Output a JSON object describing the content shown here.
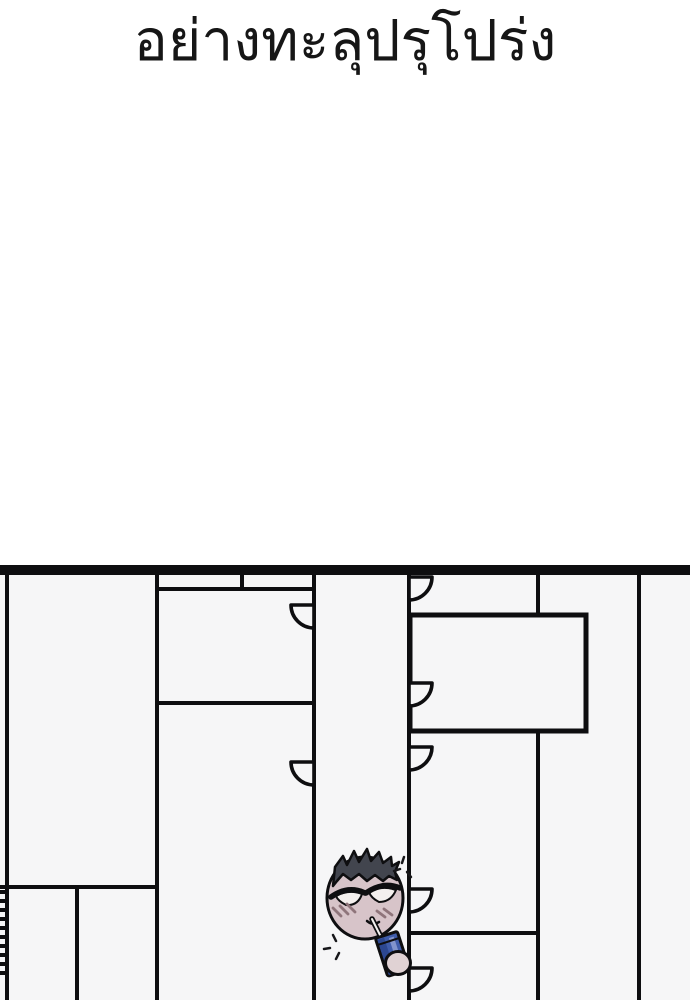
{
  "title": {
    "text": "อย่างทะลุปรุโปร่ง"
  },
  "colors": {
    "ink": "#0e0e10",
    "paper": "#ffffff",
    "panel_bg": "#f6f6f7",
    "face": "#d7c4c9",
    "hair": "#42454e",
    "eye_white": "#f4f0ee",
    "blush": "#8f757b",
    "straw": "#f3f1ef",
    "juice_main": "#3f5caa",
    "juice_dark": "#2c4791",
    "juice_light": "#8294cc",
    "hand": "#e0d2d4"
  }
}
